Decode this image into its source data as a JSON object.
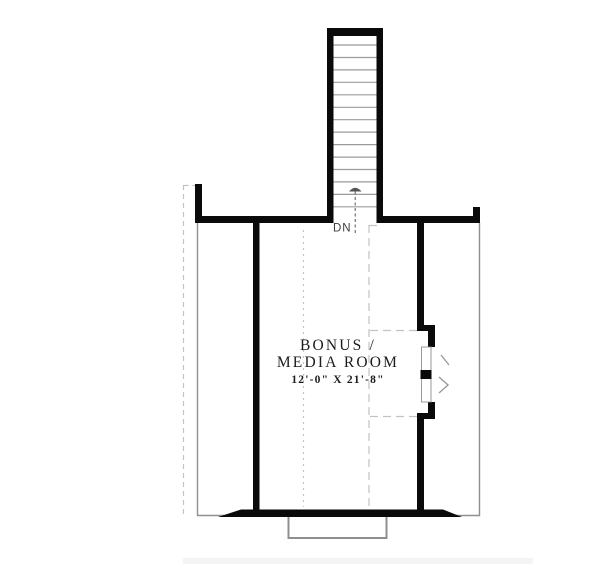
{
  "plan": {
    "room": {
      "name_line1": "BONUS /",
      "name_line2": "MEDIA ROOM",
      "dimensions": "12'-0\" X 21'-8\""
    },
    "stairs": {
      "label": "DN",
      "direction": "down",
      "tread_count": 14
    },
    "colors": {
      "wall": "#0a0a0a",
      "thin_line": "#8f8f8f",
      "tread": "#9b9b9b",
      "dashed": "#c2c2c2",
      "arrow": "#555555",
      "text": "#1c1c1c",
      "label": "#3d3d3d",
      "footer_bar": "#f4f4f4",
      "background": "#ffffff"
    }
  }
}
